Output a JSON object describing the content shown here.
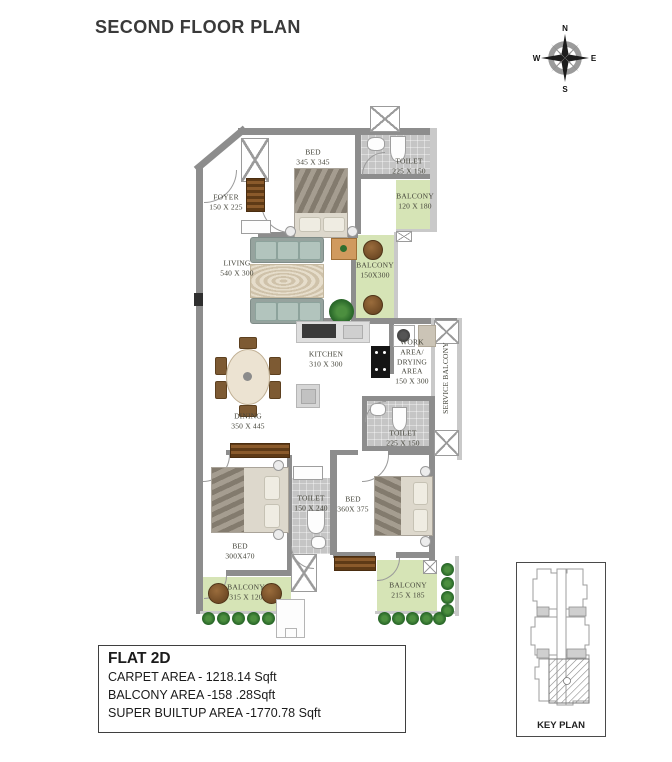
{
  "title": "SECOND FLOOR PLAN",
  "compass": {
    "n": "N",
    "e": "E",
    "s": "S",
    "w": "W"
  },
  "rooms": [
    {
      "name": "FOYER",
      "dims": "150 X 225"
    },
    {
      "name": "BED",
      "dims": "345 X 345"
    },
    {
      "name": "TOILET",
      "dims": "225 X 150"
    },
    {
      "name": "BALCONY",
      "dims": "120 X 180"
    },
    {
      "name": "LIVING",
      "dims": "540 X 300"
    },
    {
      "name": "BALCONY",
      "dims": "150X300"
    },
    {
      "name": "KITCHEN",
      "dims": "310 X 300"
    },
    {
      "name": "WORK AREA/ DRYING AREA",
      "dims": "150 X 300"
    },
    {
      "name": "SERVICE BALCONY",
      "dims": ""
    },
    {
      "name": "DINING",
      "dims": "350 X 445"
    },
    {
      "name": "TOILET",
      "dims": "225 X 150"
    },
    {
      "name": "TOILET",
      "dims": "150 X 240"
    },
    {
      "name": "BED",
      "dims": "360X 375"
    },
    {
      "name": "BED",
      "dims": "300X470"
    },
    {
      "name": "BALCONY",
      "dims": "315 X 120"
    },
    {
      "name": "BALCONY",
      "dims": "215 X 185"
    }
  ],
  "info_box": {
    "flat": "FLAT 2D",
    "carpet": "CARPET AREA - 1218.14 Sqft",
    "balcony": "BALCONY AREA -158 .28Sqft",
    "super": "SUPER BUILTUP AREA -1770.78 Sqft"
  },
  "key_plan": {
    "label": "KEY PLAN"
  }
}
